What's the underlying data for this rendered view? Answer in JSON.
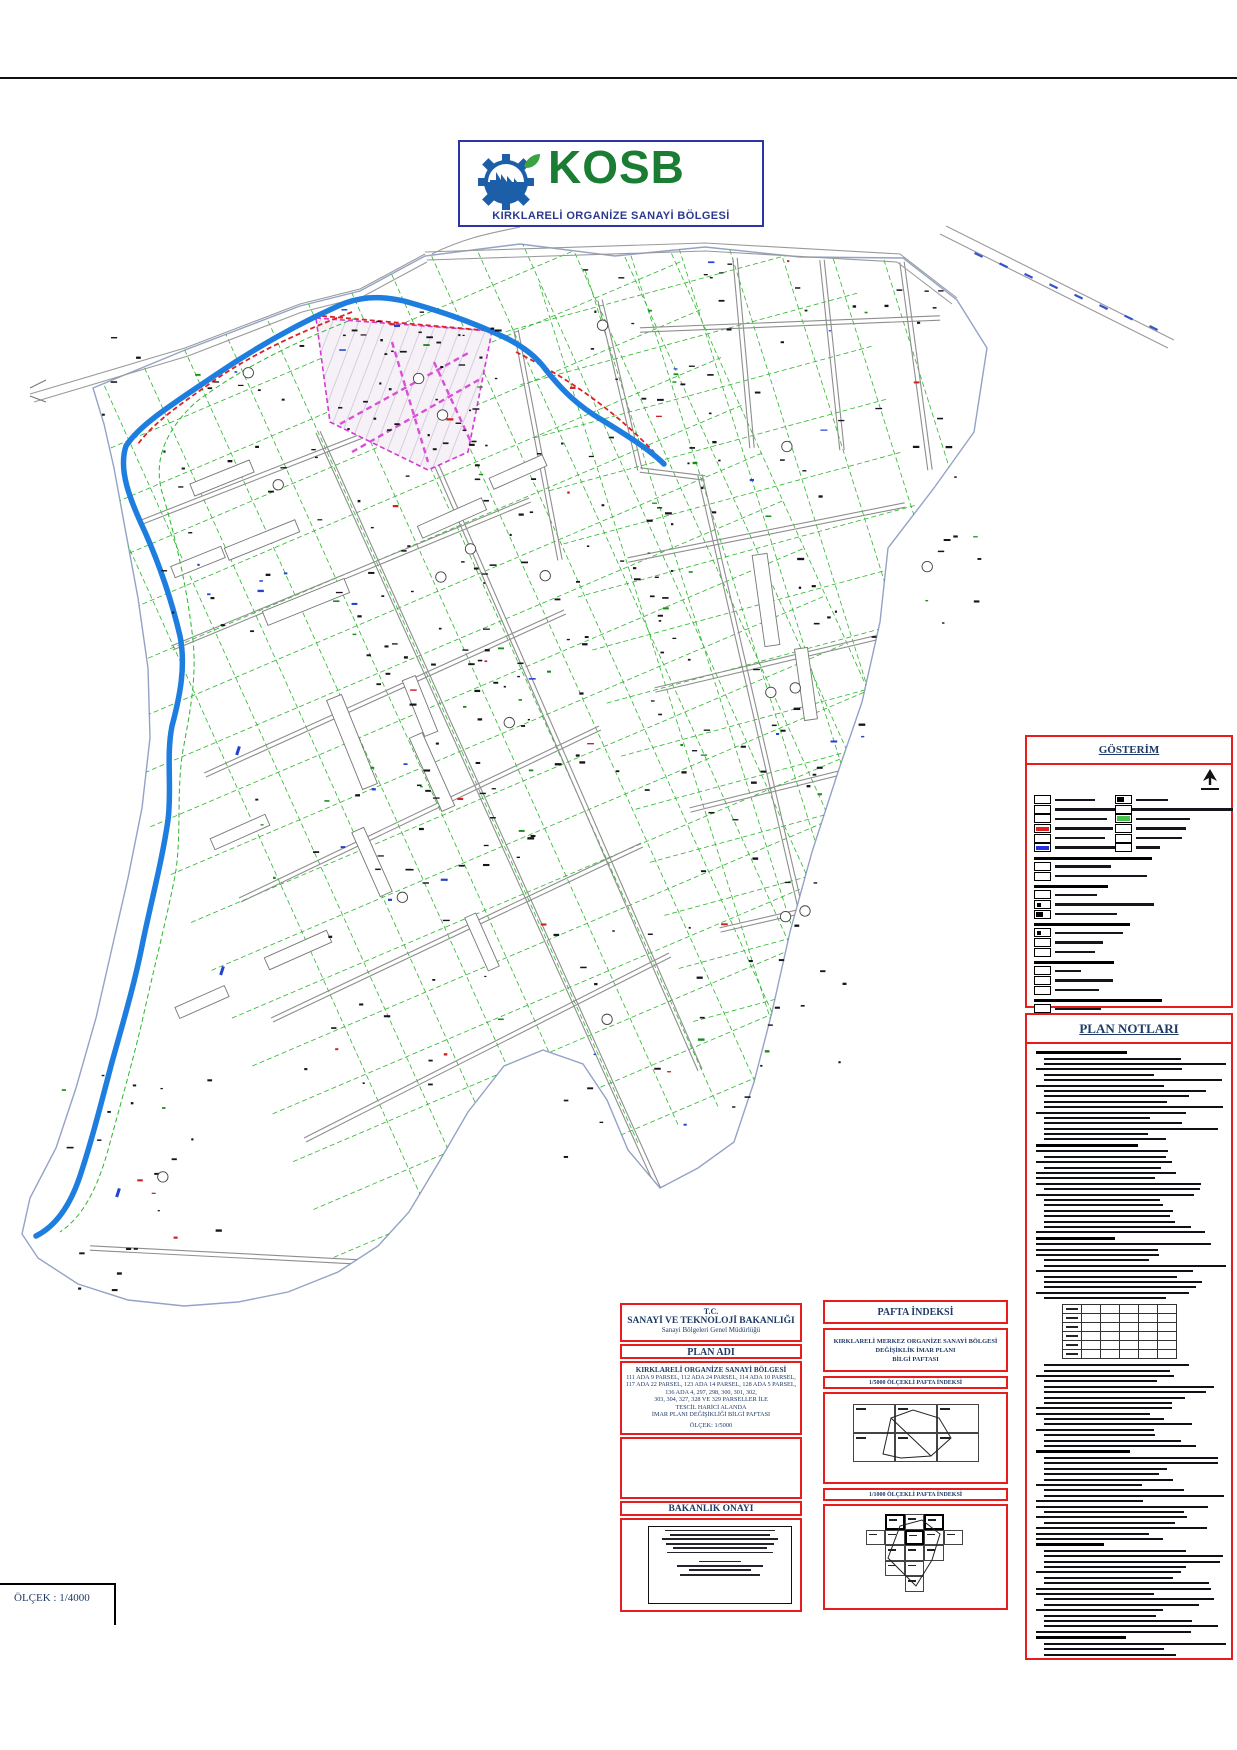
{
  "page": {
    "scale_label": "ÖLÇEK : 1/4000"
  },
  "logo": {
    "title": "KOSB",
    "subtitle": "KIRKLARELİ ORGANİZE SANAYİ BÖLGESİ",
    "accent_green": "#1b7d33",
    "accent_blue": "#1c5fa8",
    "border_blue": "#2d35a5"
  },
  "legend": {
    "title": "GÖSTERİM",
    "col1": [
      {
        "t": "s",
        "sw": "white",
        "w": 40
      },
      {
        "t": "s",
        "sw": "white",
        "w": 85
      },
      {
        "t": "s",
        "sw": "white",
        "w": 52
      },
      {
        "t": "s",
        "sw": "red",
        "w": 58
      },
      {
        "t": "s",
        "sw": "white",
        "w": 50
      },
      {
        "t": "s",
        "sw": "blue",
        "w": 66
      },
      {
        "t": "h",
        "w": 118
      },
      {
        "t": "s",
        "sw": "white",
        "w": 56
      },
      {
        "t": "s",
        "sw": "white",
        "w": 92
      },
      {
        "t": "h",
        "w": 74
      },
      {
        "t": "s",
        "sw": "white",
        "w": 42
      },
      {
        "t": "s",
        "sw": "dot",
        "w": 112
      },
      {
        "t": "s",
        "sw": "half",
        "w": 62
      },
      {
        "t": "h",
        "w": 96
      },
      {
        "t": "s",
        "sw": "dot",
        "w": 68
      },
      {
        "t": "s",
        "sw": "white",
        "w": 48
      },
      {
        "t": "s",
        "sw": "white",
        "w": 40
      },
      {
        "t": "h",
        "w": 80
      },
      {
        "t": "s",
        "sw": "white",
        "w": 26
      },
      {
        "t": "s",
        "sw": "white",
        "w": 58
      },
      {
        "t": "s",
        "sw": "white",
        "w": 44
      },
      {
        "t": "h",
        "w": 128
      },
      {
        "t": "s",
        "sw": "white",
        "w": 46
      }
    ],
    "col2": [
      {
        "t": "s",
        "sw": "half",
        "w": 32
      },
      {
        "t": "s",
        "sw": "white",
        "w": 100
      },
      {
        "t": "s",
        "sw": "green",
        "w": 54
      },
      {
        "t": "s",
        "sw": "white",
        "w": 50
      },
      {
        "t": "s",
        "sw": "white",
        "w": 46
      },
      {
        "t": "s",
        "sw": "white",
        "w": 24
      }
    ]
  },
  "plan_notes": {
    "title": "PLAN NOTLARI",
    "lines_before_table": 46,
    "lines_after_table": 54
  },
  "title_block": {
    "tc": {
      "line1": "T.C.",
      "line2": "SANAYİ VE TEKNOLOJİ BAKANLIĞI",
      "line3": "Sanayi Bölgeleri Genel Müdürlüğü"
    },
    "plan_adi": {
      "title": "PLAN ADI",
      "subtitle": "KIRKLARELİ ORGANİZE SANAYİ BÖLGESİ",
      "lines": [
        "111 ADA 9 PARSEL, 112 ADA 24 PARSEL, 114 ADA 10 PARSEL,",
        "117 ADA 22 PARSEL, 123 ADA 14 PARSEL, 128 ADA 5 PARSEL,",
        "136 ADA 4, 297, 298, 300, 301, 302,",
        "303, 304, 327, 328 VE 329 PARSELLER İLE",
        "TESCİL HARİCİ ALANDA",
        "İMAR PLANI DEĞİŞİKLİĞİ BİLGİ PAFTASI"
      ],
      "scale_line": "ÖLÇEK: 1/5000"
    },
    "bakanlik": {
      "title": "BAKANLIK ONAYI"
    }
  },
  "pafta": {
    "title": "PAFTA İNDEKSİ",
    "desc": [
      "KIRKLARELİ MERKEZ ORGANİZE SANAYİ BÖLGESİ",
      "DEĞİŞİKLİK İMAR PLANI",
      "BİLGİ PAFTASI"
    ],
    "idx5000_label": "1/5000 ÖLÇEKLİ PAFTA İNDEKSİ",
    "idx5000_grid": {
      "cols": 3,
      "rows": 2
    },
    "idx1000_label": "1/1000 ÖLÇEKLİ PAFTA İNDEKSİ",
    "idx1000_grid": {
      "cells": [
        [
          0,
          1,
          1,
          1,
          0
        ],
        [
          1,
          1,
          1,
          1,
          1
        ],
        [
          0,
          1,
          1,
          1,
          0
        ],
        [
          0,
          1,
          1,
          0,
          0
        ],
        [
          0,
          0,
          1,
          0,
          0
        ]
      ],
      "bold": [
        [
          0,
          1
        ],
        [
          0,
          3
        ],
        [
          1,
          2
        ]
      ]
    }
  },
  "map": {
    "colors": {
      "boundary": "#93a2c6",
      "stream": "#1e7ee0",
      "parcel_green": "#2db52d",
      "road_gray": "#8e8e8e",
      "zone_magenta": "#d338d3",
      "change_red": "#dd2222",
      "speck_black": "#15151a",
      "speck_green": "#1c8a1c",
      "speck_red": "#cc2222",
      "speck_blue": "#2244cc"
    }
  }
}
